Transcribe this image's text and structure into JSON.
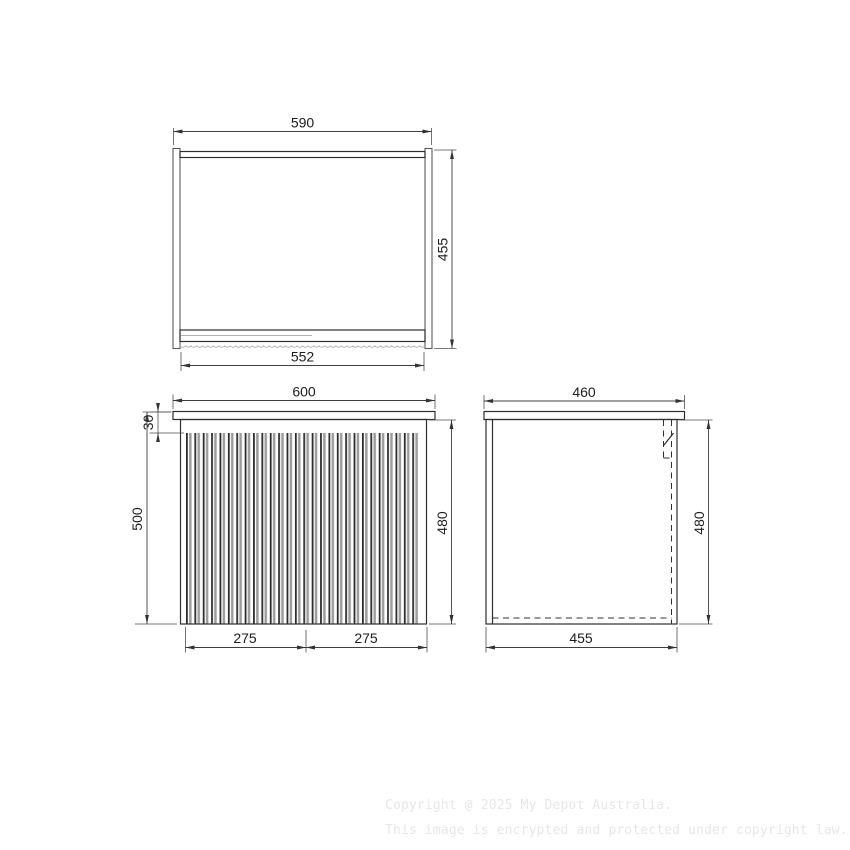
{
  "views": {
    "top": {
      "label": "top-view",
      "width": "590",
      "depth": "455",
      "shelf_width": "552"
    },
    "front": {
      "label": "front-view",
      "overall_width": "600",
      "top_gap": "30",
      "overall_height": "500",
      "body_height": "480",
      "door_left": "275",
      "door_right": "275"
    },
    "side": {
      "label": "side-view",
      "top_depth": "460",
      "body_height": "480",
      "body_depth": "455"
    }
  },
  "watermark": {
    "line1": "Copyright @ 2025 My Depot Australia.",
    "line2": "This image is encrypted and protected under copyright law."
  },
  "colors": {
    "line": "#2e2e2e",
    "flute_shadow": "#9c9c9c",
    "watermark": "#e7e7e7"
  }
}
